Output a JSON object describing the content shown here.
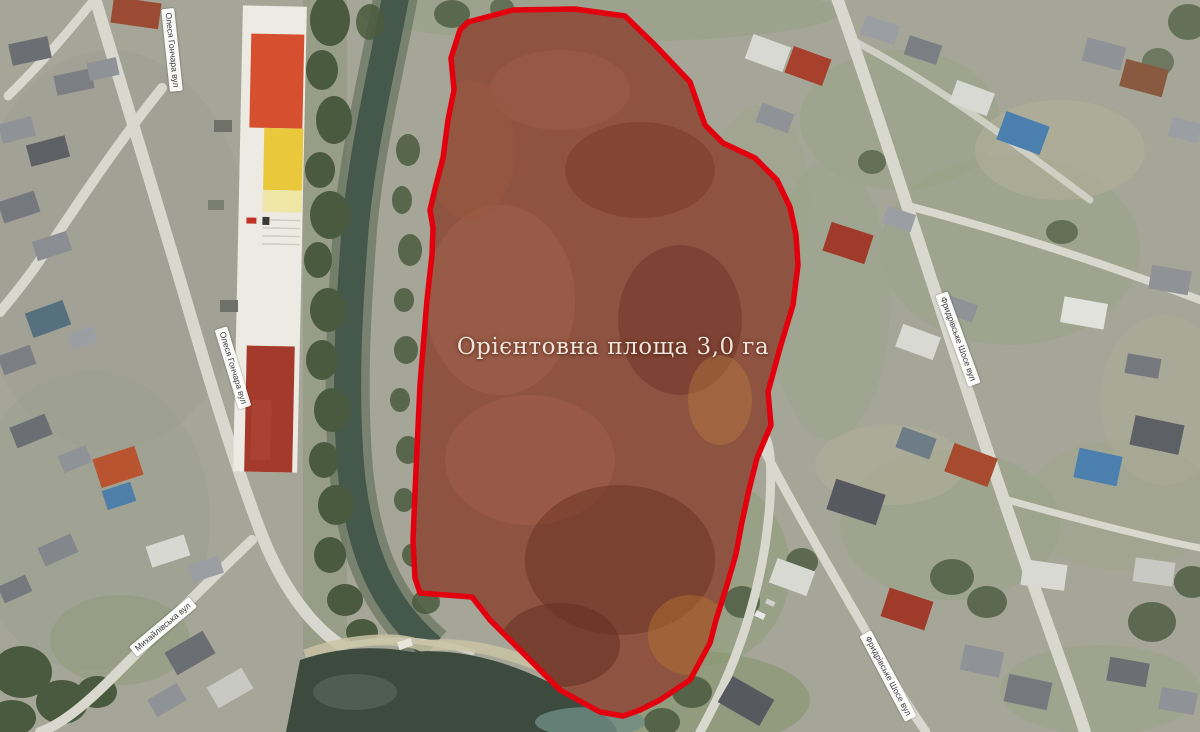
{
  "map": {
    "type": "satellite-aerial-annotated",
    "annotation": {
      "area_label": "Орієнтовна площа 3,0 га",
      "outline_color": "#e3000e",
      "plot_fill_color": "#8f5342"
    },
    "street_labels": [
      {
        "name": "street-olesia-honchara-top",
        "label": "Олеся Гончара вул"
      },
      {
        "name": "street-olesia-honchara-mid",
        "label": "Олеся Гончара вул"
      },
      {
        "name": "street-mykhailivska",
        "label": "Михайлівська вул"
      },
      {
        "name": "street-frydrivske-shose-upper",
        "label": "Фридрівське Шосе вул"
      },
      {
        "name": "street-frydrivske-shose-lower",
        "label": "Фридрівське Шосе вул"
      }
    ],
    "palette": {
      "land": "#a5a697",
      "water": "#3d4b3f",
      "road": "#d9d8cf",
      "trees": "#4a5a3e"
    }
  }
}
